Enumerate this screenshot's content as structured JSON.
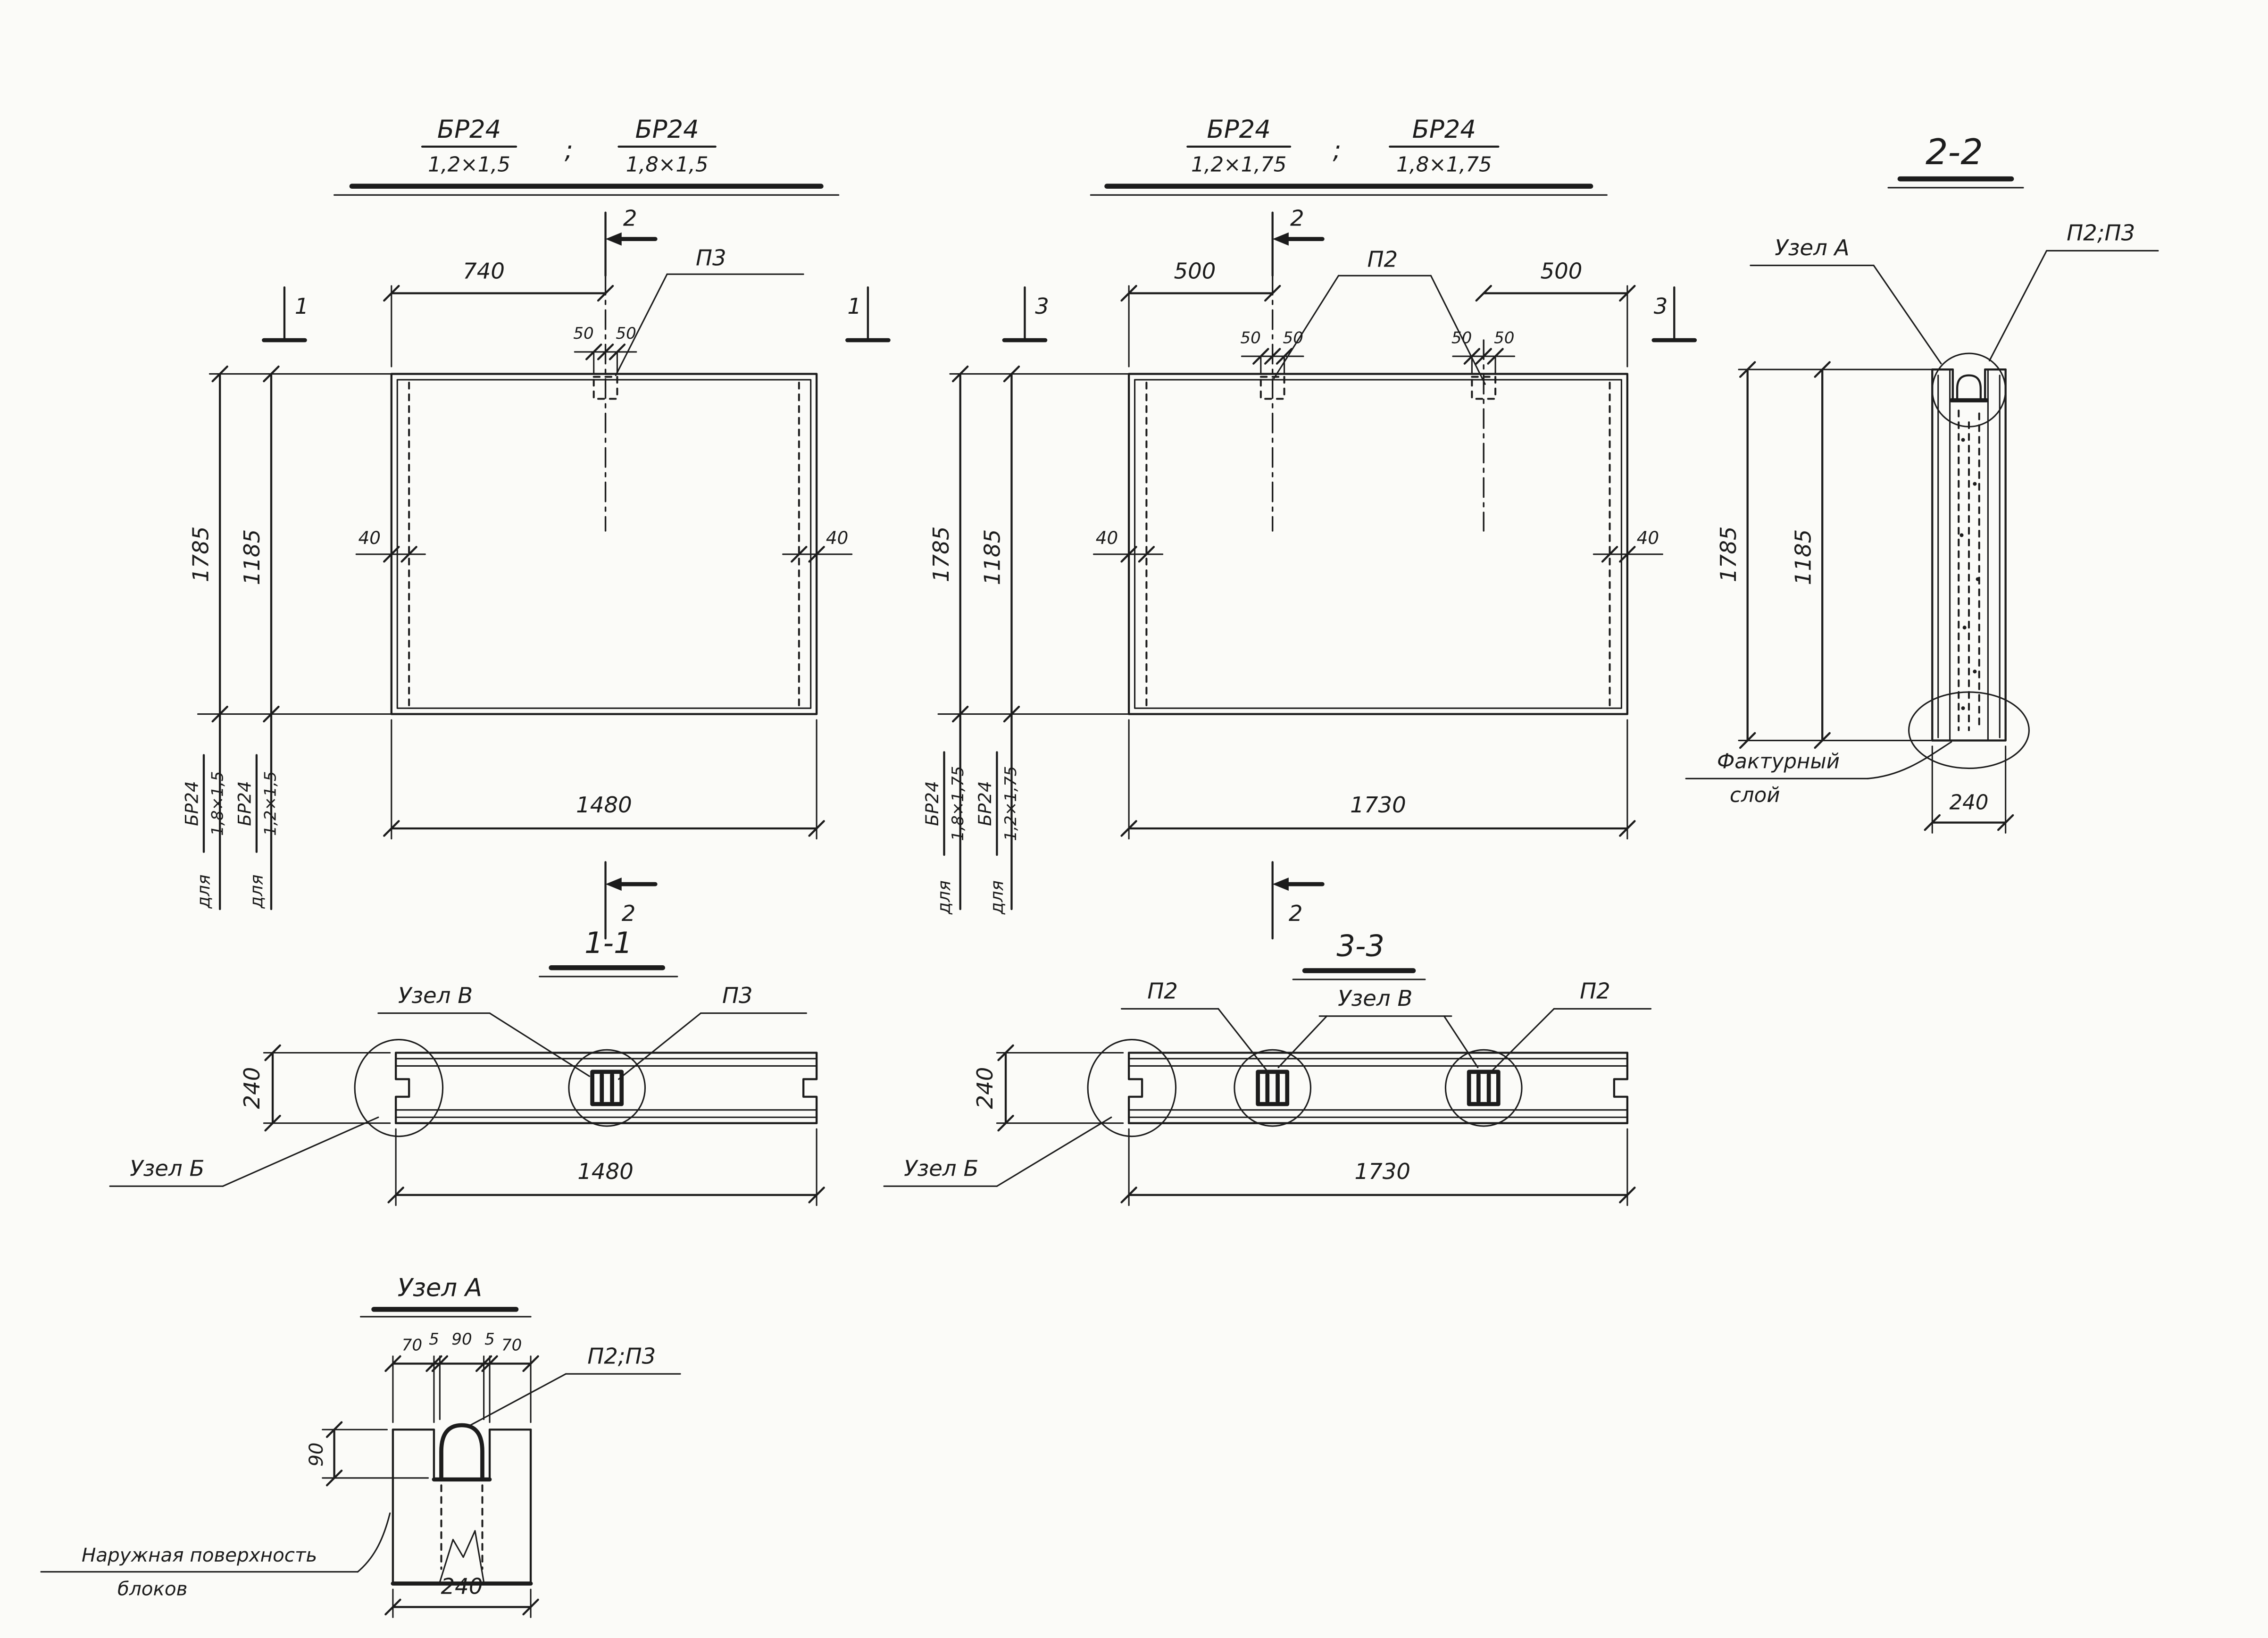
{
  "palette": {
    "bg": "#fbfbf8",
    "ink": "#1c1c1c"
  },
  "titles": {
    "left_block": {
      "f1_num": "БР24",
      "f1_den": "1,2×1,5",
      "sep": ";",
      "f2_num": "БР24",
      "f2_den": "1,8×1,5"
    },
    "middle_block": {
      "f1_num": "БР24",
      "f1_den": "1,2×1,75",
      "sep": ";",
      "f2_num": "БР24",
      "f2_den": "1,8×1,75"
    },
    "section_2_2": "2-2",
    "section_1_1": "1-1",
    "section_3_3": "3-3",
    "node_a": "Узел А"
  },
  "elevation_left": {
    "dim_740": "740",
    "dim_50_l": "50",
    "dim_50_r": "50",
    "label_p3": "П3",
    "cut_2_top": "2",
    "cut_2_bottom": "2",
    "cut_1_left": "1",
    "cut_1_right": "1",
    "dim_height_outer": "1785",
    "dim_height_inner": "1185",
    "dim_40_left": "40",
    "dim_40_right": "40",
    "dim_width": "1480",
    "for_outer_word": "для",
    "for_outer_num": "БР24",
    "for_outer_den": "1,8×1,5",
    "for_inner_word": "для",
    "for_inner_num": "БР24",
    "for_inner_den": "1,2×1,5"
  },
  "elevation_middle": {
    "dim_500_l": "500",
    "dim_500_r": "500",
    "dim_50_ll": "50",
    "dim_50_lr": "50",
    "dim_50_rl": "50",
    "dim_50_rr": "50",
    "label_p2": "П2",
    "cut_2_top": "2",
    "cut_2_bottom": "2",
    "cut_3_left": "3",
    "cut_3_right": "3",
    "dim_height_outer": "1785",
    "dim_height_inner": "1185",
    "dim_40_left": "40",
    "dim_40_right": "40",
    "dim_width": "1730",
    "for_outer_word": "для",
    "for_outer_num": "БР24",
    "for_outer_den": "1,8×1,75",
    "for_inner_word": "для",
    "for_inner_num": "БР24",
    "for_inner_den": "1,2×1,75"
  },
  "section_2_2": {
    "label_node_a": "Узел А",
    "label_p": "П2;П3",
    "dim_height_outer": "1785",
    "dim_height_inner": "1185",
    "label_texture_line1": "Фактурный",
    "label_texture_line2": "слой",
    "dim_thickness": "240"
  },
  "section_1_1": {
    "label_node_v": "Узел В",
    "label_p3": "П3",
    "label_node_b": "Узел Б",
    "dim_thickness": "240",
    "dim_width": "1480"
  },
  "section_3_3": {
    "label_p2_left": "П2",
    "label_node_v": "Узел В",
    "label_p2_right": "П2",
    "label_node_b": "Узел Б",
    "dim_thickness": "240",
    "dim_width": "1730"
  },
  "node_a_detail": {
    "dim_70_l": "70",
    "dim_5_l": "5",
    "dim_90_top": "90",
    "dim_5_r": "5",
    "dim_70_r": "70",
    "label_p": "П2;П3",
    "dim_90_side": "90",
    "dim_240": "240",
    "label_surface_line1": "Наружная поверхность",
    "label_surface_line2": "блоков"
  }
}
